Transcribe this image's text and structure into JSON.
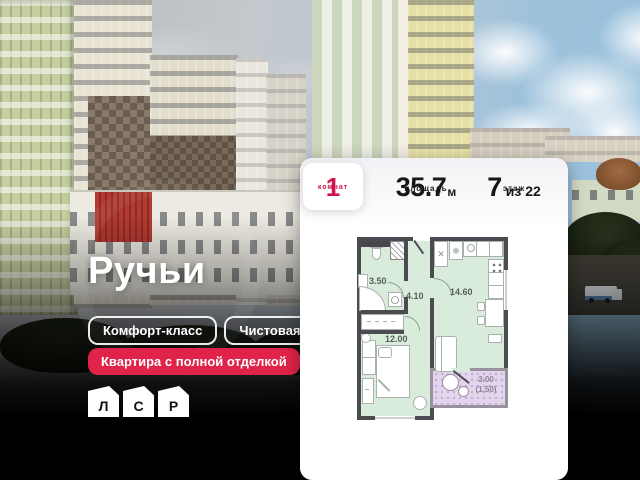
{
  "overlay": {
    "project_title": "Ручьи",
    "tags": [
      {
        "label": "Комфорт-класс"
      },
      {
        "label": "Чистовая"
      }
    ],
    "highlight_badge": "Квартира с полной отделкой",
    "developer_logo": {
      "letters": [
        "Л",
        "С",
        "Р"
      ]
    }
  },
  "listing_card": {
    "stats": [
      {
        "value": "1",
        "label": "комнат"
      },
      {
        "value": "35.7",
        "unit": "м",
        "label": "площадь"
      },
      {
        "value": "7",
        "unit": "из 22",
        "label": "этаж"
      }
    ],
    "floor_plan": {
      "rooms": [
        {
          "name": "bathroom",
          "area": "3.50"
        },
        {
          "name": "hallway",
          "area": "4.10"
        },
        {
          "name": "kitchen-living-room",
          "area": "14.60"
        },
        {
          "name": "bedroom",
          "area": "12.00"
        },
        {
          "name": "balcony",
          "area": "3.00",
          "area_secondary": "(1.50)"
        }
      ]
    }
  },
  "icons": {
    "fridge-icon": "❄",
    "fan-icon": "✕"
  },
  "colors": {
    "accent_red": "#e02349",
    "stat_number_red": "#d0144a",
    "plan_room_fill": "#d9ecdc",
    "plan_balcony_fill": "#e3d5ec",
    "plan_wall": "#4b4b52"
  }
}
